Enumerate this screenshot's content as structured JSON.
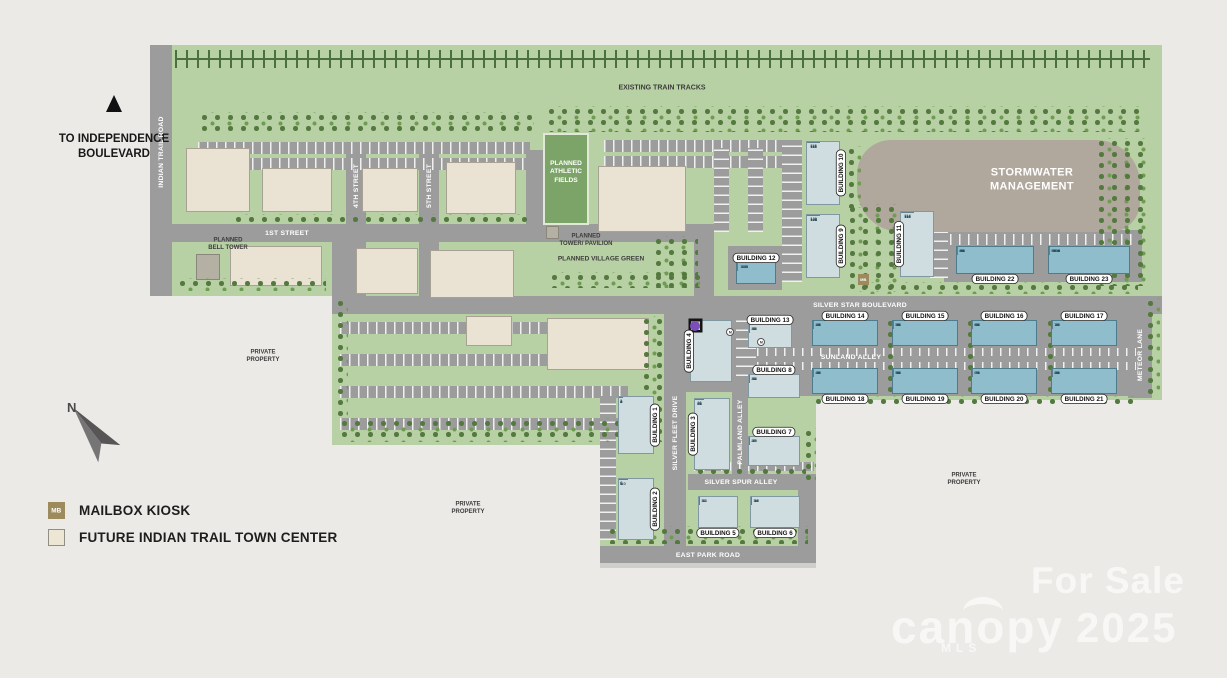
{
  "offsite": {
    "text": "TO INDEPENDENCE\nBOULEVARD"
  },
  "compass": {
    "label": "N"
  },
  "legend": {
    "mb_abbr": "MB",
    "items": [
      {
        "label": "MAILBOX KIOSK"
      },
      {
        "label": "FUTURE INDIAN TRAIL TOWN CENTER"
      }
    ]
  },
  "watermarks": {
    "for_sale": "For Sale",
    "brand": "canopy",
    "brand_sub": "MLS",
    "year": "2025"
  },
  "map": {
    "m_circle_label": "M",
    "green_areas": [
      {
        "x": 150,
        "y": 45,
        "w": 1012,
        "h": 251
      },
      {
        "x": 332,
        "y": 296,
        "w": 308,
        "h": 149
      },
      {
        "x": 600,
        "y": 296,
        "w": 216,
        "h": 250
      },
      {
        "x": 816,
        "y": 296,
        "w": 346,
        "h": 104
      }
    ],
    "roads": [
      {
        "x": 150,
        "y": 45,
        "w": 22,
        "h": 251
      },
      {
        "x": 172,
        "y": 224,
        "w": 542,
        "h": 18
      },
      {
        "x": 346,
        "y": 150,
        "w": 20,
        "h": 74
      },
      {
        "x": 419,
        "y": 150,
        "w": 20,
        "h": 74
      },
      {
        "x": 526,
        "y": 150,
        "w": 18,
        "h": 74
      },
      {
        "x": 332,
        "y": 242,
        "w": 18,
        "h": 54
      },
      {
        "x": 346,
        "y": 242,
        "w": 20,
        "h": 54
      },
      {
        "x": 419,
        "y": 242,
        "w": 20,
        "h": 54
      },
      {
        "x": 694,
        "y": 242,
        "w": 20,
        "h": 54
      },
      {
        "x": 332,
        "y": 296,
        "w": 830,
        "h": 18
      },
      {
        "x": 664,
        "y": 314,
        "w": 22,
        "h": 233
      },
      {
        "x": 732,
        "y": 390,
        "w": 16,
        "h": 84
      },
      {
        "x": 688,
        "y": 474,
        "w": 128,
        "h": 16
      },
      {
        "x": 798,
        "y": 488,
        "w": 18,
        "h": 58
      },
      {
        "x": 600,
        "y": 546,
        "w": 216,
        "h": 17
      },
      {
        "x": 1128,
        "y": 314,
        "w": 24,
        "h": 84
      },
      {
        "x": 944,
        "y": 230,
        "w": 198,
        "h": 52
      },
      {
        "x": 744,
        "y": 314,
        "w": 398,
        "h": 82
      },
      {
        "x": 684,
        "y": 314,
        "w": 72,
        "h": 78
      },
      {
        "x": 728,
        "y": 246,
        "w": 54,
        "h": 44
      }
    ],
    "walks": [
      {
        "x": 600,
        "y": 563,
        "w": 216,
        "h": 5
      }
    ],
    "parking": [
      {
        "x": 198,
        "y": 142,
        "w": 332,
        "h": 12,
        "d": "v"
      },
      {
        "x": 198,
        "y": 158,
        "w": 332,
        "h": 12,
        "d": "v"
      },
      {
        "x": 604,
        "y": 140,
        "w": 182,
        "h": 12,
        "d": "v"
      },
      {
        "x": 604,
        "y": 156,
        "w": 182,
        "h": 12,
        "d": "v"
      },
      {
        "x": 714,
        "y": 148,
        "w": 15,
        "h": 84,
        "d": "h"
      },
      {
        "x": 748,
        "y": 148,
        "w": 15,
        "h": 84,
        "d": "h"
      },
      {
        "x": 782,
        "y": 140,
        "w": 20,
        "h": 142,
        "d": "h"
      },
      {
        "x": 930,
        "y": 214,
        "w": 18,
        "h": 64,
        "d": "h"
      },
      {
        "x": 950,
        "y": 234,
        "w": 186,
        "h": 11,
        "d": "v"
      },
      {
        "x": 340,
        "y": 322,
        "w": 288,
        "h": 12,
        "d": "v"
      },
      {
        "x": 340,
        "y": 354,
        "w": 288,
        "h": 12,
        "d": "v"
      },
      {
        "x": 340,
        "y": 386,
        "w": 288,
        "h": 12,
        "d": "v"
      },
      {
        "x": 340,
        "y": 418,
        "w": 288,
        "h": 12,
        "d": "v"
      },
      {
        "x": 600,
        "y": 396,
        "w": 16,
        "h": 144,
        "d": "h"
      },
      {
        "x": 748,
        "y": 348,
        "w": 388,
        "h": 8,
        "d": "v"
      },
      {
        "x": 748,
        "y": 362,
        "w": 388,
        "h": 8,
        "d": "v"
      },
      {
        "x": 736,
        "y": 320,
        "w": 20,
        "h": 56,
        "d": "h"
      },
      {
        "x": 694,
        "y": 462,
        "w": 120,
        "h": 9,
        "d": "v"
      }
    ],
    "tracks": {
      "x": 175,
      "y": 50,
      "w": 975
    },
    "stormwater": {
      "x": 857,
      "y": 140,
      "w": 283,
      "h": 92,
      "lx": 1032,
      "ly": 180,
      "label": "STORMWATER\nMANAGEMENT"
    },
    "athletic": {
      "x": 543,
      "y": 133,
      "w": 46,
      "h": 92,
      "lx": 566,
      "ly": 172,
      "label": "PLANNED\nATHLETIC\nFIELDS"
    },
    "structures": [
      {
        "name": "planned-bell-tower-structure",
        "x": 196,
        "y": 254,
        "w": 24,
        "h": 26
      },
      {
        "name": "planned-tower-pavilion-structure",
        "x": 546,
        "y": 226,
        "w": 13,
        "h": 13
      }
    ],
    "commercial": [
      {
        "x": 186,
        "y": 148,
        "w": 64,
        "h": 64
      },
      {
        "x": 262,
        "y": 168,
        "w": 70,
        "h": 44
      },
      {
        "x": 362,
        "y": 168,
        "w": 56,
        "h": 44
      },
      {
        "x": 446,
        "y": 162,
        "w": 70,
        "h": 52
      },
      {
        "x": 598,
        "y": 166,
        "w": 88,
        "h": 66
      },
      {
        "x": 230,
        "y": 246,
        "w": 92,
        "h": 40
      },
      {
        "x": 356,
        "y": 248,
        "w": 62,
        "h": 46
      },
      {
        "x": 430,
        "y": 250,
        "w": 84,
        "h": 48
      },
      {
        "x": 466,
        "y": 316,
        "w": 46,
        "h": 30
      },
      {
        "x": 547,
        "y": 318,
        "w": 102,
        "h": 52
      }
    ],
    "tree_strips": [
      {
        "x": 198,
        "y": 112,
        "w": 336,
        "h": 20
      },
      {
        "x": 545,
        "y": 106,
        "w": 600,
        "h": 26
      },
      {
        "x": 1095,
        "y": 138,
        "w": 54,
        "h": 148
      },
      {
        "x": 845,
        "y": 146,
        "w": 16,
        "h": 62
      },
      {
        "x": 846,
        "y": 204,
        "w": 52,
        "h": 88
      },
      {
        "x": 338,
        "y": 418,
        "w": 298,
        "h": 24
      },
      {
        "x": 334,
        "y": 298,
        "w": 14,
        "h": 124
      },
      {
        "x": 640,
        "y": 316,
        "w": 22,
        "h": 126
      },
      {
        "x": 606,
        "y": 526,
        "w": 202,
        "h": 18
      },
      {
        "x": 802,
        "y": 428,
        "w": 14,
        "h": 58
      },
      {
        "x": 548,
        "y": 272,
        "w": 152,
        "h": 16
      },
      {
        "x": 652,
        "y": 236,
        "w": 46,
        "h": 52
      },
      {
        "x": 884,
        "y": 318,
        "w": 9,
        "h": 74
      },
      {
        "x": 964,
        "y": 318,
        "w": 9,
        "h": 74
      },
      {
        "x": 1044,
        "y": 318,
        "w": 9,
        "h": 74
      },
      {
        "x": 1144,
        "y": 298,
        "w": 16,
        "h": 100
      },
      {
        "x": 176,
        "y": 278,
        "w": 150,
        "h": 13
      },
      {
        "x": 232,
        "y": 214,
        "w": 300,
        "h": 9
      },
      {
        "x": 812,
        "y": 396,
        "w": 326,
        "h": 9
      },
      {
        "x": 694,
        "y": 466,
        "w": 112,
        "h": 8
      },
      {
        "x": 858,
        "y": 282,
        "w": 280,
        "h": 12
      }
    ],
    "townhomes": [
      {
        "label": "BUILDING 1",
        "x": 618,
        "y": 396,
        "w": 36,
        "h": 58,
        "dir": "col",
        "tone": "light",
        "side": "right",
        "units": [
          "1",
          "2",
          "3",
          "4",
          "5"
        ]
      },
      {
        "label": "BUILDING 2",
        "x": 618,
        "y": 478,
        "w": 36,
        "h": 62,
        "dir": "col",
        "tone": "light",
        "side": "right",
        "units": [
          "6",
          "7",
          "8",
          "9",
          "10"
        ]
      },
      {
        "label": "BUILDING 3",
        "x": 694,
        "y": 398,
        "w": 36,
        "h": 72,
        "dir": "col",
        "tone": "light",
        "side": "left",
        "units": [
          "26",
          "25",
          "24",
          "23",
          "22"
        ]
      },
      {
        "label": "BUILDING 4",
        "x": 690,
        "y": 320,
        "w": 42,
        "h": 62,
        "dir": "col",
        "tone": "light",
        "side": "left",
        "units": [
          "30",
          "29",
          "28",
          "27"
        ],
        "markers": [
          {
            "i": 0,
            "c": "#e3c554"
          },
          {
            "i": 1,
            "c": "#b7a6d8"
          },
          {
            "i": 2,
            "c": "#b7a6d8"
          },
          {
            "i": 3,
            "c": "#7b4fb8",
            "box": 1
          }
        ]
      },
      {
        "label": "BUILDING 5",
        "x": 698,
        "y": 496,
        "w": 40,
        "h": 32,
        "dir": "row",
        "tone": "light",
        "side": "bottom",
        "units": [
          "11",
          "12",
          "13"
        ]
      },
      {
        "label": "BUILDING 6",
        "x": 750,
        "y": 496,
        "w": 50,
        "h": 32,
        "dir": "row",
        "tone": "light",
        "side": "bottom",
        "units": [
          "14",
          "15",
          "16",
          "17"
        ]
      },
      {
        "label": "BUILDING 7",
        "x": 748,
        "y": 436,
        "w": 52,
        "h": 30,
        "dir": "row",
        "tone": "light",
        "side": "top",
        "units": [
          "21",
          "20",
          "19",
          "18"
        ]
      },
      {
        "label": "BUILDING 8",
        "x": 748,
        "y": 374,
        "w": 52,
        "h": 24,
        "dir": "row",
        "tone": "light",
        "side": "top",
        "units": [
          "31",
          "32",
          "33",
          "34"
        ]
      },
      {
        "label": "BUILDING 9",
        "x": 806,
        "y": 214,
        "w": 34,
        "h": 64,
        "dir": "col",
        "tone": "light",
        "side": "right",
        "units": [
          "120",
          "121",
          "122",
          "123",
          "124"
        ]
      },
      {
        "label": "BUILDING 10",
        "x": 806,
        "y": 141,
        "w": 34,
        "h": 64,
        "dir": "col",
        "tone": "light",
        "side": "right",
        "units": [
          "115",
          "116",
          "117",
          "118",
          "119"
        ]
      },
      {
        "label": "BUILDING 11",
        "x": 900,
        "y": 211,
        "w": 34,
        "h": 66,
        "dir": "col",
        "tone": "light",
        "side": "left",
        "units": [
          "114",
          "113",
          "112",
          "111",
          "110"
        ]
      },
      {
        "label": "BUILDING 12",
        "x": 736,
        "y": 262,
        "w": 40,
        "h": 22,
        "dir": "row",
        "tone": "medium",
        "side": "top",
        "units": [
          "107",
          "108",
          "109"
        ]
      },
      {
        "label": "BUILDING 13",
        "x": 748,
        "y": 324,
        "w": 44,
        "h": 24,
        "dir": "row",
        "tone": "light",
        "side": "top",
        "units": [
          "35",
          "36",
          "37",
          "38"
        ]
      },
      {
        "label": "BUILDING 14",
        "x": 812,
        "y": 320,
        "w": 66,
        "h": 26,
        "dir": "row",
        "tone": "medium",
        "side": "top",
        "units": [
          "39",
          "40",
          "41",
          "42",
          "43",
          "44"
        ]
      },
      {
        "label": "BUILDING 15",
        "x": 892,
        "y": 320,
        "w": 66,
        "h": 26,
        "dir": "row",
        "tone": "medium",
        "side": "top",
        "units": [
          "51",
          "52",
          "53",
          "54",
          "55",
          "56"
        ]
      },
      {
        "label": "BUILDING 16",
        "x": 971,
        "y": 320,
        "w": 66,
        "h": 26,
        "dir": "row",
        "tone": "medium",
        "side": "top",
        "units": [
          "63",
          "64",
          "65",
          "66",
          "67",
          "68"
        ]
      },
      {
        "label": "BUILDING 17",
        "x": 1051,
        "y": 320,
        "w": 66,
        "h": 26,
        "dir": "row",
        "tone": "medium",
        "side": "top",
        "units": [
          "75",
          "76",
          "77",
          "78",
          "79",
          "80"
        ]
      },
      {
        "label": "BUILDING 18",
        "x": 812,
        "y": 368,
        "w": 66,
        "h": 26,
        "dir": "row",
        "tone": "medium",
        "side": "bottom",
        "units": [
          "45",
          "46",
          "47",
          "48",
          "49",
          "50"
        ]
      },
      {
        "label": "BUILDING 19",
        "x": 892,
        "y": 368,
        "w": 66,
        "h": 26,
        "dir": "row",
        "tone": "medium",
        "side": "bottom",
        "units": [
          "57",
          "58",
          "59",
          "60",
          "61",
          "62"
        ]
      },
      {
        "label": "BUILDING 20",
        "x": 971,
        "y": 368,
        "w": 66,
        "h": 26,
        "dir": "row",
        "tone": "medium",
        "side": "bottom",
        "units": [
          "69",
          "70",
          "71",
          "72",
          "73",
          "74"
        ]
      },
      {
        "label": "BUILDING 21",
        "x": 1051,
        "y": 368,
        "w": 66,
        "h": 26,
        "dir": "row",
        "tone": "medium",
        "side": "bottom",
        "units": [
          "81",
          "82",
          "83",
          "84",
          "85",
          "86"
        ]
      },
      {
        "label": "BUILDING 22",
        "x": 956,
        "y": 246,
        "w": 78,
        "h": 28,
        "dir": "row",
        "tone": "medium",
        "side": "bottom",
        "units": [
          "87",
          "88",
          "89",
          "90",
          "91",
          "92",
          "93",
          "94",
          "95",
          "96"
        ]
      },
      {
        "label": "BUILDING 23",
        "x": 1048,
        "y": 246,
        "w": 82,
        "h": 28,
        "dir": "row",
        "tone": "medium",
        "side": "bottom",
        "units": [
          "97",
          "98",
          "99",
          "100",
          "101",
          "102",
          "103",
          "104",
          "105",
          "106"
        ]
      }
    ],
    "road_labels": [
      {
        "t": "INDIAN TRAIL ROAD",
        "x": 161,
        "y": 152,
        "r": 1
      },
      {
        "t": "1ST STREET",
        "x": 287,
        "y": 233
      },
      {
        "t": "4TH STREET",
        "x": 356,
        "y": 186,
        "r": 1
      },
      {
        "t": "5TH STREET",
        "x": 429,
        "y": 186,
        "r": 1
      },
      {
        "t": "SILVER STAR BOULEVARD",
        "x": 860,
        "y": 305
      },
      {
        "t": "SUNLAND ALLEY",
        "x": 851,
        "y": 357
      },
      {
        "t": "SILVER FLEET DRIVE",
        "x": 675,
        "y": 433,
        "r": 1
      },
      {
        "t": "PALMLAND ALLEY",
        "x": 740,
        "y": 432,
        "r": 1
      },
      {
        "t": "SILVER SPUR ALLEY",
        "x": 741,
        "y": 482
      },
      {
        "t": "EAST PARK ROAD",
        "x": 708,
        "y": 555
      },
      {
        "t": "METEOR LANE",
        "x": 1140,
        "y": 355,
        "r": 1
      }
    ],
    "features": [
      {
        "t": "EXISTING TRAIN TRACKS",
        "x": 662,
        "y": 88,
        "s": 7
      },
      {
        "t": "PLANNED\nBELL TOWER",
        "x": 228,
        "y": 244,
        "s": 6
      },
      {
        "t": "PLANNED\nTOWER/ PAVILION",
        "x": 586,
        "y": 240,
        "s": 6
      },
      {
        "t": "PLANNED VILLAGE GREEN",
        "x": 601,
        "y": 259,
        "s": 6.5
      },
      {
        "t": "PRIVATE\nPROPERTY",
        "x": 263,
        "y": 356,
        "s": 6
      },
      {
        "t": "PRIVATE\nPROPERTY",
        "x": 468,
        "y": 508,
        "s": 6
      },
      {
        "t": "PRIVATE\nPROPERTY",
        "x": 964,
        "y": 479,
        "s": 6
      }
    ],
    "mb_markers": [
      {
        "x": 858,
        "y": 274
      }
    ],
    "m_circles": [
      {
        "x": 726,
        "y": 328
      },
      {
        "x": 757,
        "y": 338
      }
    ]
  }
}
